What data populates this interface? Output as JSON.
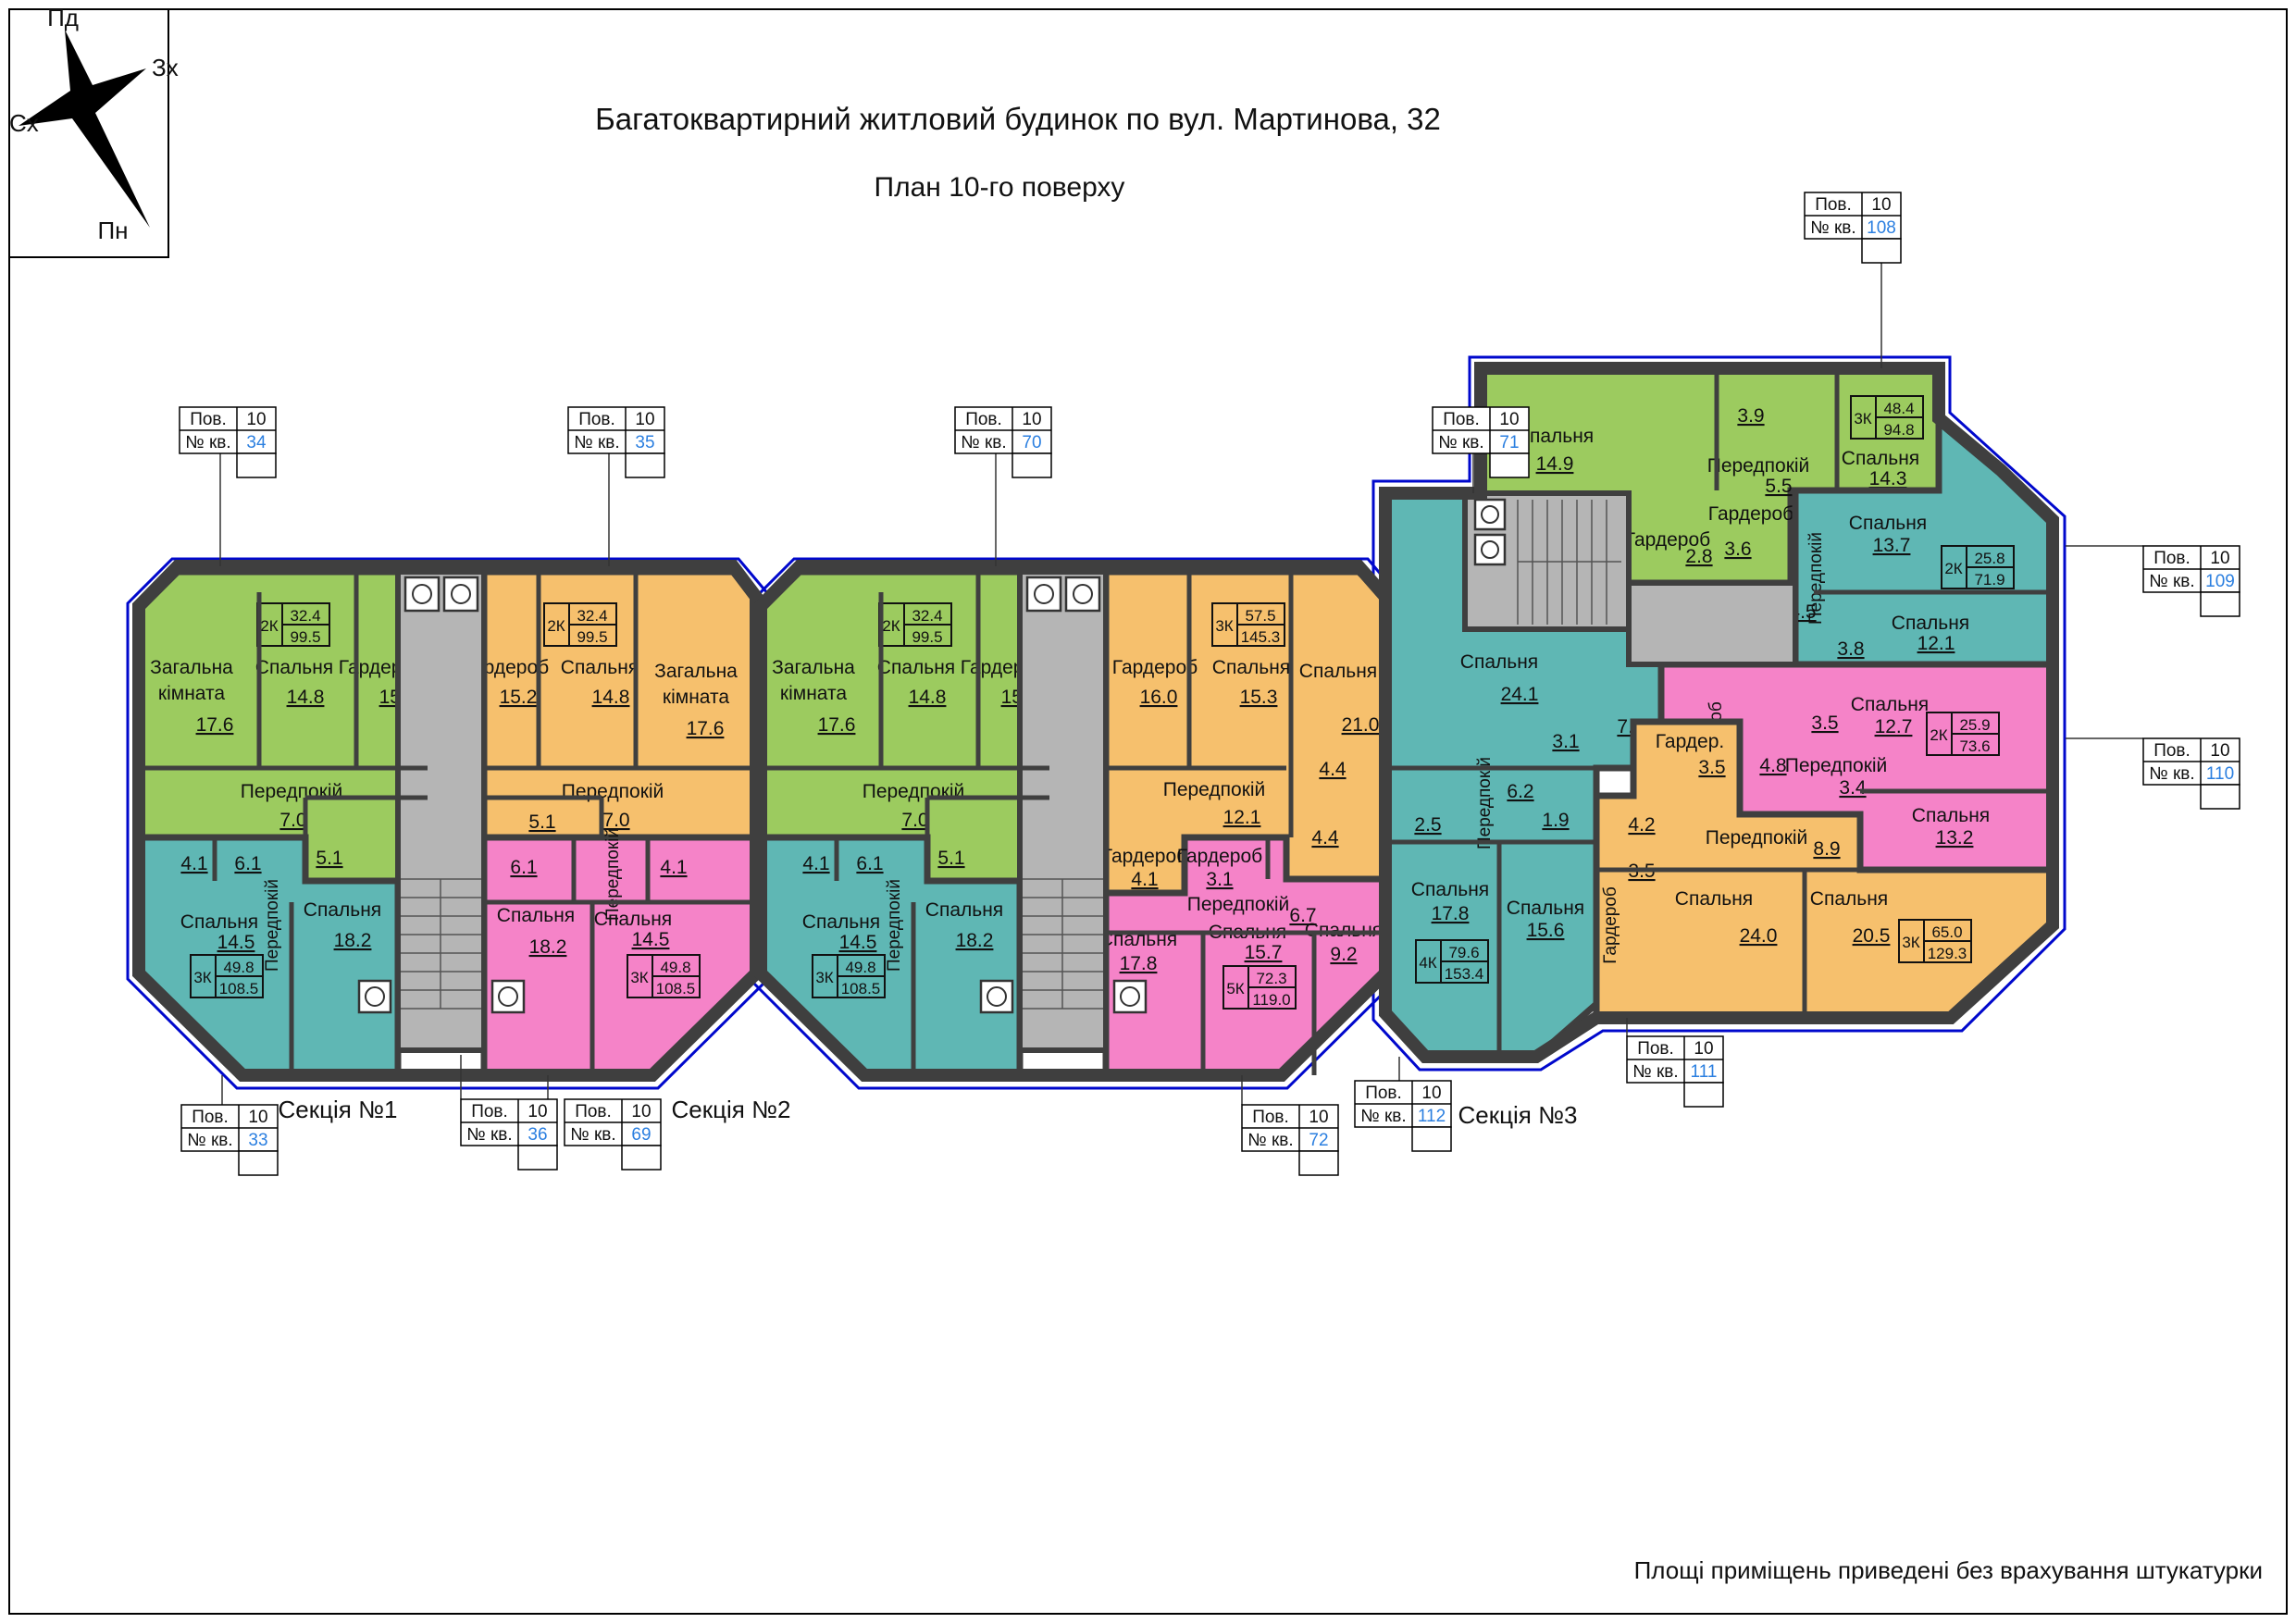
{
  "title": "Багатоквартирний житловий будинок по вул. Мартинова, 32",
  "subtitle": "План 10-го поверху",
  "note": "Площі приміщень приведені без врахування штукатурки",
  "compass": {
    "top": "Пд",
    "right": "Зх",
    "left": "Сх",
    "bottom": "Пн"
  },
  "sections": {
    "s1": "Секція №1",
    "s2": "Секція №2",
    "s3": "Секція №3"
  },
  "callout": {
    "floor_label": "Пов.",
    "apt_label": "№ кв.",
    "floor": "10"
  },
  "callout_numbers": {
    "c33": "33",
    "c34": "34",
    "c35": "35",
    "c36": "36",
    "c69": "69",
    "c70": "70",
    "c71": "71",
    "c72": "72",
    "c108": "108",
    "c109": "109",
    "c110": "110",
    "c111": "111",
    "c112": "112"
  },
  "colors": {
    "green": "#9ccb5f",
    "orange": "#f6c06d",
    "pink": "#f583c8",
    "teal": "#5fb7b4",
    "walls": "#3f3f3f",
    "stair": "#b5b5b5",
    "window": "#0008cc",
    "apartment_number": "#2b7fe0"
  },
  "apartments": {
    "s1a": {
      "k": "2К",
      "l": "32.4",
      "t": "99.5",
      "zag1": "Загальна",
      "zag2": "кімната",
      "zag_a": "17.6",
      "bed": "Спальня",
      "bed_a": "14.8",
      "ward": "Гардероб",
      "ward_a": "15.2",
      "hall": "Передпокій",
      "hall_a": "7.0",
      "bath_a": "5.1"
    },
    "s1b": {
      "k": "3К",
      "l": "49.8",
      "t": "108.5",
      "bed1": "Спальня",
      "bed1_a": "14.5",
      "bed2": "Спальня",
      "bed2_a": "18.2",
      "hall": "Передпокій",
      "wc_a": "4.1",
      "bath_a": "6.1"
    },
    "s1c": {
      "k": "2К",
      "l": "32.4",
      "t": "99.5",
      "zag1": "Загальна",
      "zag2": "кімната",
      "zag_a": "17.6",
      "bed": "Спальня",
      "bed_a": "14.8",
      "ward": "Гардероб",
      "ward_a": "15.2",
      "hall": "Передпокій",
      "hall_a": "7.0",
      "bath_a": "5.1"
    },
    "s1d": {
      "k": "3К",
      "l": "49.8",
      "t": "108.5",
      "bed1": "Спальня",
      "bed1_a": "18.2",
      "bed2": "Спальня",
      "bed2_a": "14.5",
      "hall": "Передпокій",
      "bath_a": "6.1",
      "wc_a": "4.1"
    },
    "s2a": {
      "k": "2К",
      "l": "32.4",
      "t": "99.5",
      "zag1": "Загальна",
      "zag2": "кімната",
      "zag_a": "17.6",
      "bed": "Спальня",
      "bed_a": "14.8",
      "ward": "Гардероб",
      "ward_a": "15.2",
      "hall": "Передпокій",
      "hall_a": "7.0",
      "bath_a": "5.1"
    },
    "s2b": {
      "k": "3К",
      "l": "49.8",
      "t": "108.5",
      "bed1": "Спальня",
      "bed1_a": "14.5",
      "bed2": "Спальня",
      "bed2_a": "18.2",
      "hall": "Передпокій",
      "wc_a": "4.1",
      "bath_a": "6.1"
    },
    "s2c": {
      "k": "3К",
      "l": "57.5",
      "t": "145.3",
      "ward1": "Гардероб",
      "ward1_a": "16.0",
      "bed1": "Спальня",
      "bed1_a": "15.3",
      "bed2": "Спальня",
      "bed2_a": "21.0",
      "wc_a": "4.4",
      "hall": "Передпокій",
      "hall_a": "12.1",
      "ward2": "Гардероб",
      "ward2_a": "4.1"
    },
    "s2d": {
      "k": "5К",
      "l": "72.3",
      "t": "119.0",
      "ward": "Гардероб",
      "ward_a": "3.1",
      "wc_a": "4.4",
      "hall": "Передпокій",
      "hall_a": "6.7",
      "bed1": "Спальня",
      "bed1_a": "17.8",
      "bed2": "Спальня",
      "bed2_a": "15.7",
      "bed3": "Спальня",
      "bed3_a": "9.2"
    },
    "s3a": {
      "k": "4К",
      "l": "79.6",
      "t": "153.4",
      "bed1": "Спальня",
      "bed1_a": "24.1",
      "r7": "7.0",
      "r31": "3.1",
      "hall": "Передпокій",
      "hall_a": "6.2",
      "r25": "2.5",
      "r19": "1.9",
      "bed2": "Спальня",
      "bed2_a": "17.8",
      "bed3": "Спальня",
      "bed3_a": "15.6"
    },
    "s3b": {
      "k": "3К",
      "l": "48.4",
      "t": "94.8",
      "bed1": "Спальня",
      "bed1_a": "14.9",
      "r39": "3.9",
      "hall": "Передпокій",
      "hall_a": "5.5",
      "bed2": "Спальня",
      "bed2_a": "14.3",
      "ward1": "Гардероб",
      "ward1_a": "2.8",
      "ward2": "Гардероб",
      "ward2_a": "3.6"
    },
    "s3c": {
      "k": "2К",
      "l": "25.8",
      "t": "71.9",
      "bed1": "Спальня",
      "bed1_a": "13.7",
      "hall": "Передпокій",
      "r45": "4.5",
      "r38": "3.8",
      "bed2": "Спальня",
      "bed2_a": "12.1"
    },
    "s3d": {
      "k": "2К",
      "l": "25.9",
      "t": "73.6",
      "r35": "3.5",
      "bed1": "Спальня",
      "bed1_a": "12.7",
      "ward": "Гардероб",
      "ward_a": "4.8",
      "hall": "Передпокій",
      "hall_a": "3.4",
      "bed2": "Спальня",
      "bed2_a": "13.2"
    },
    "s3e": {
      "k": "3К",
      "l": "65.0",
      "t": "129.3",
      "ward1": "Гардер.",
      "ward1_a": "3.5",
      "r42": "4.2",
      "ward2": "Гардероб",
      "ward2_a": "3.5",
      "hall": "Передпокій",
      "hall_a": "8.9",
      "bed1": "Спальня",
      "bed1_a": "24.0",
      "bed2": "Спальня",
      "bed2_a": "20.5"
    }
  }
}
